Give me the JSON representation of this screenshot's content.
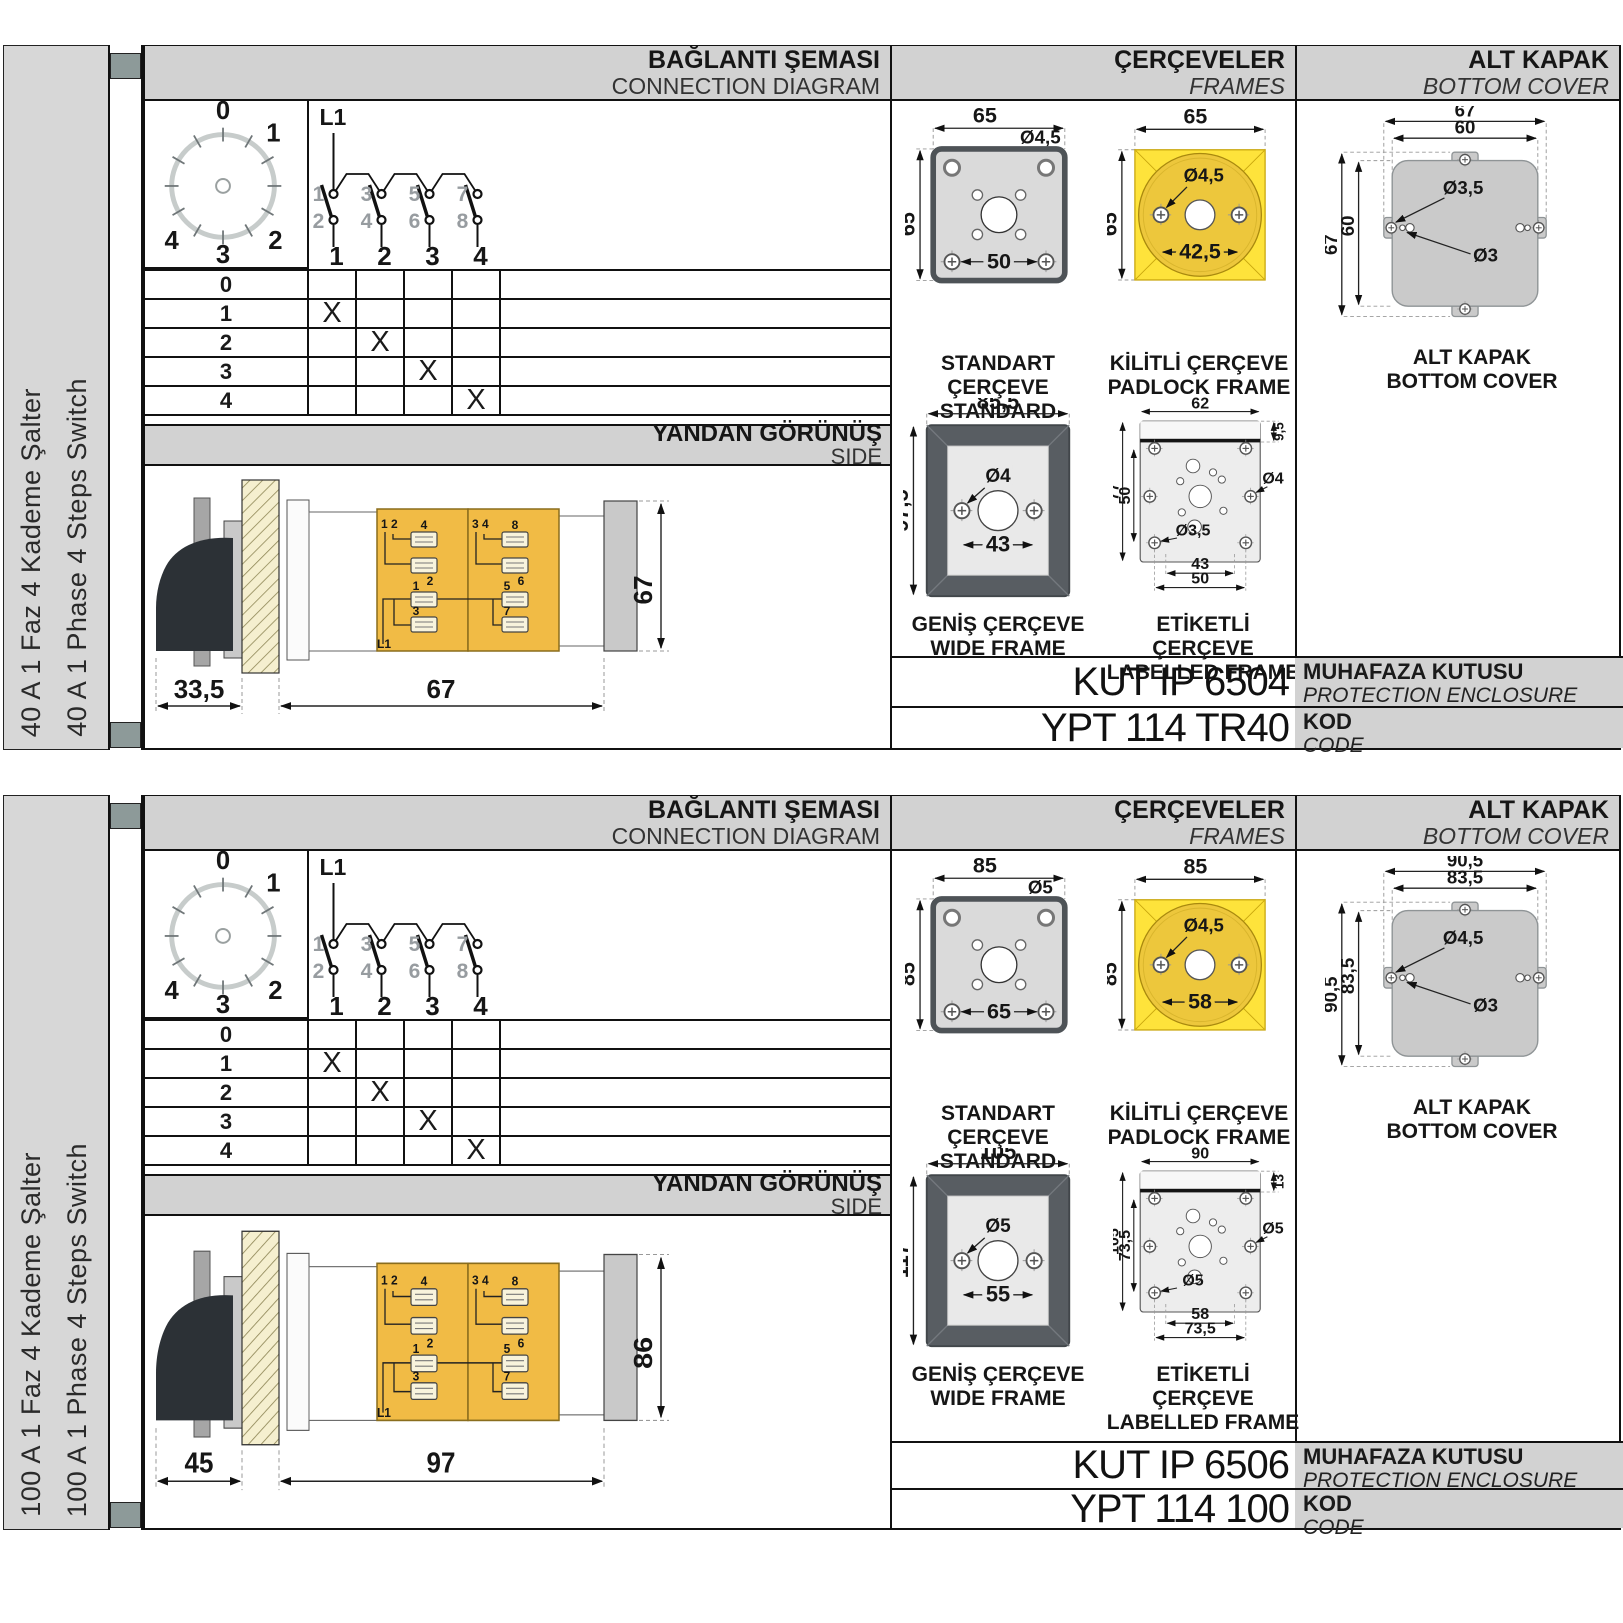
{
  "labels": {
    "conn_title": "BAĞLANTI ŞEMASI",
    "conn_sub": "CONNECTION DIAGRAM",
    "frames_title": "ÇERÇEVELER",
    "frames_sub": "FRAMES",
    "cover_title": "ALT KAPAK",
    "cover_sub": "BOTTOM COVER",
    "side_title": "YANDAN GÖRÜNÜŞ",
    "side_sub": "SIDE",
    "standard_caption_tr": "STANDART ÇERÇEVE",
    "standard_caption_en": "STANDARD FRAME",
    "padlock_caption_tr": "KİLİTLİ ÇERÇEVE",
    "padlock_caption_en": "PADLOCK FRAME",
    "wide_caption_tr": "GENİŞ ÇERÇEVE",
    "wide_caption_en": "WIDE FRAME",
    "labelled_caption_tr": "ETİKETLİ ÇERÇEVE",
    "labelled_caption_en": "LABELLED FRAME",
    "cover_caption_tr": "ALT KAPAK",
    "cover_caption_en": "BOTTOM COVER",
    "enclosure_tr": "MUHAFAZA KUTUSU",
    "enclosure_en": "PROTECTION ENCLOSURE",
    "kod_tr": "KOD",
    "kod_en": "CODE"
  },
  "shared": {
    "dial": {
      "p0": "0",
      "p1": "1",
      "p2": "2",
      "p3": "3",
      "p4": "4"
    },
    "schematic": {
      "phase": "L1",
      "top": [
        "1",
        "3",
        "5",
        "7"
      ],
      "bottom": [
        "2",
        "4",
        "6",
        "8"
      ],
      "terminals": [
        "1",
        "2",
        "3",
        "4"
      ]
    },
    "table": {
      "rows": [
        {
          "label": "0",
          "marks": [
            "",
            "",
            "",
            ""
          ]
        },
        {
          "label": "1",
          "marks": [
            "X",
            "",
            "",
            ""
          ]
        },
        {
          "label": "2",
          "marks": [
            "",
            "X",
            "",
            ""
          ]
        },
        {
          "label": "3",
          "marks": [
            "",
            "",
            "X",
            ""
          ]
        },
        {
          "label": "4",
          "marks": [
            "",
            "",
            "",
            "X"
          ]
        }
      ]
    },
    "sideview": {
      "pair_left": "1 2",
      "pair_right": "3 4",
      "t1l": "4",
      "t1r": "8",
      "t2l": "2",
      "t2r": "6",
      "t3l": "1",
      "t3r": "5",
      "t4l": "3",
      "t4r": "7",
      "phase": "L1"
    }
  },
  "colors": {
    "panel_gray": "#d7d7d7",
    "band_gray": "#d2d2d2",
    "tab_slate": "#8d9a99",
    "accent_yellow": "#fee33b",
    "circle_yellow": "#edc73c",
    "body_yellow": "#f1bb45",
    "frame_dark": "#585d62",
    "plate_gray": "#cacaca",
    "cream_hatch": "#f5efcf",
    "line_black": "#111111"
  },
  "sections": [
    {
      "sidebar_tr": "40 A 1 Faz 4 Kademe Şalter",
      "sidebar_en": "40 A 1 Phase 4 Steps Switch",
      "standard": {
        "w": "65",
        "h": "65",
        "hole": "Ø4,5",
        "pitch": "50"
      },
      "padlock": {
        "w": "65",
        "h": "65",
        "hole": "Ø4,5",
        "pitch": "42,5"
      },
      "wide": {
        "w": "85,5",
        "h": "97,5",
        "hole": "Ø4",
        "pitch": "43"
      },
      "labelled": {
        "w": "62",
        "h": "77",
        "inner_h": "50",
        "tab": "9,5",
        "hole_right": "Ø4",
        "hole_left": "Ø3,5",
        "pitch_a": "43",
        "pitch_b": "50"
      },
      "cover": {
        "w_out": "67",
        "w_in": "60",
        "h_out": "67",
        "h_in": "60",
        "hole_a": "Ø3,5",
        "hole_b": "Ø3"
      },
      "side": {
        "front": "33,5",
        "body": "67",
        "height": "67"
      },
      "enclosure_code": "KUT IP 6504",
      "code": "YPT 114 TR40"
    },
    {
      "sidebar_tr": "100 A 1 Faz 4 Kademe Şalter",
      "sidebar_en": "100 A 1 Phase 4 Steps Switch",
      "standard": {
        "w": "85",
        "h": "85",
        "hole": "Ø5",
        "pitch": "65"
      },
      "padlock": {
        "w": "85",
        "h": "85",
        "hole": "Ø4,5",
        "pitch": "58"
      },
      "wide": {
        "w": "105",
        "h": "117",
        "hole": "Ø5",
        "pitch": "55"
      },
      "labelled": {
        "w": "90",
        "h": "105",
        "inner_h": "73,5",
        "tab": "13",
        "hole_right": "Ø5",
        "hole_left": "Ø5",
        "pitch_a": "58",
        "pitch_b": "73,5"
      },
      "cover": {
        "w_out": "90,5",
        "w_in": "83,5",
        "h_out": "90,5",
        "h_in": "83,5",
        "hole_a": "Ø4,5",
        "hole_b": "Ø3"
      },
      "side": {
        "front": "45",
        "body": "97",
        "height": "86"
      },
      "enclosure_code": "KUT IP 6506",
      "code": "YPT 114 100"
    }
  ]
}
